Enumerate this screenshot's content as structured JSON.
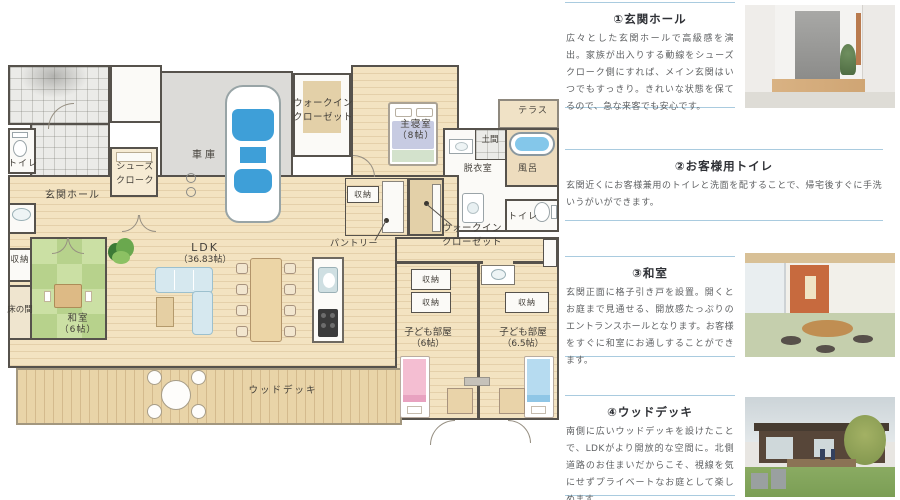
{
  "plan": {
    "labels": {
      "toilet": "トイレ",
      "hall": "玄関ホール",
      "shoes_cloak": "シューズクローク",
      "storage": "収納",
      "tokonoma": "床の間",
      "washitsu": "和室",
      "washitsu_size": "（6帖）",
      "garage": "車庫",
      "wic": "ウォークインクローゼット",
      "master": "主寝室",
      "master_size": "（8帖）",
      "terrace": "テラス",
      "doma": "土間",
      "dressing": "脱衣室",
      "bath": "風呂",
      "ldk": "LDK",
      "ldk_size": "（36.83帖）",
      "pantry": "パントリー",
      "kids": "子ども部屋",
      "kids1_size": "（6帖）",
      "kids2_size": "（6.5帖）",
      "deck": "ウッドデッキ"
    }
  },
  "sidebar": {
    "sections": [
      {
        "title": "①玄関ホール",
        "body": "広々とした玄関ホールで高級感を演出。家族が出入りする動線をシューズクローク側にすれば、メイン玄関はいつでもすっきり。きれいな状態を保てるので、急な来客でも安心です。"
      },
      {
        "title": "②お客様用トイレ",
        "body": "玄関近くにお客様兼用のトイレと洗面を配することで、帰宅後すぐに手洗いうがいができます。"
      },
      {
        "title": "③和室",
        "body": "玄関正面に格子引き戸を設置。開くとお庭まで見通せる、開放感たっぷりのエントランスホールとなります。お客様をすぐに和室にお通しすることができます。"
      },
      {
        "title": "④ウッドデッキ",
        "body": "南側に広いウッドデッキを設けたことで、LDKがより開放的な空間に。北側道路のお住まいだからこそ、視線を気にせずプライベートなお庭として楽しめます。"
      }
    ]
  },
  "colors": {
    "divider": "#a9cbdf",
    "heading": "#2f3136",
    "body_text": "#5f6163",
    "wood_floor": "#f3e3c1",
    "tatami": "#cbe0a4",
    "deck": "#e9d4a8",
    "car_glass": "#3e9fd8",
    "bath_water": "#84c7ea",
    "bed_pink": "#f4bed2",
    "bed_blue": "#b6dbf0"
  }
}
